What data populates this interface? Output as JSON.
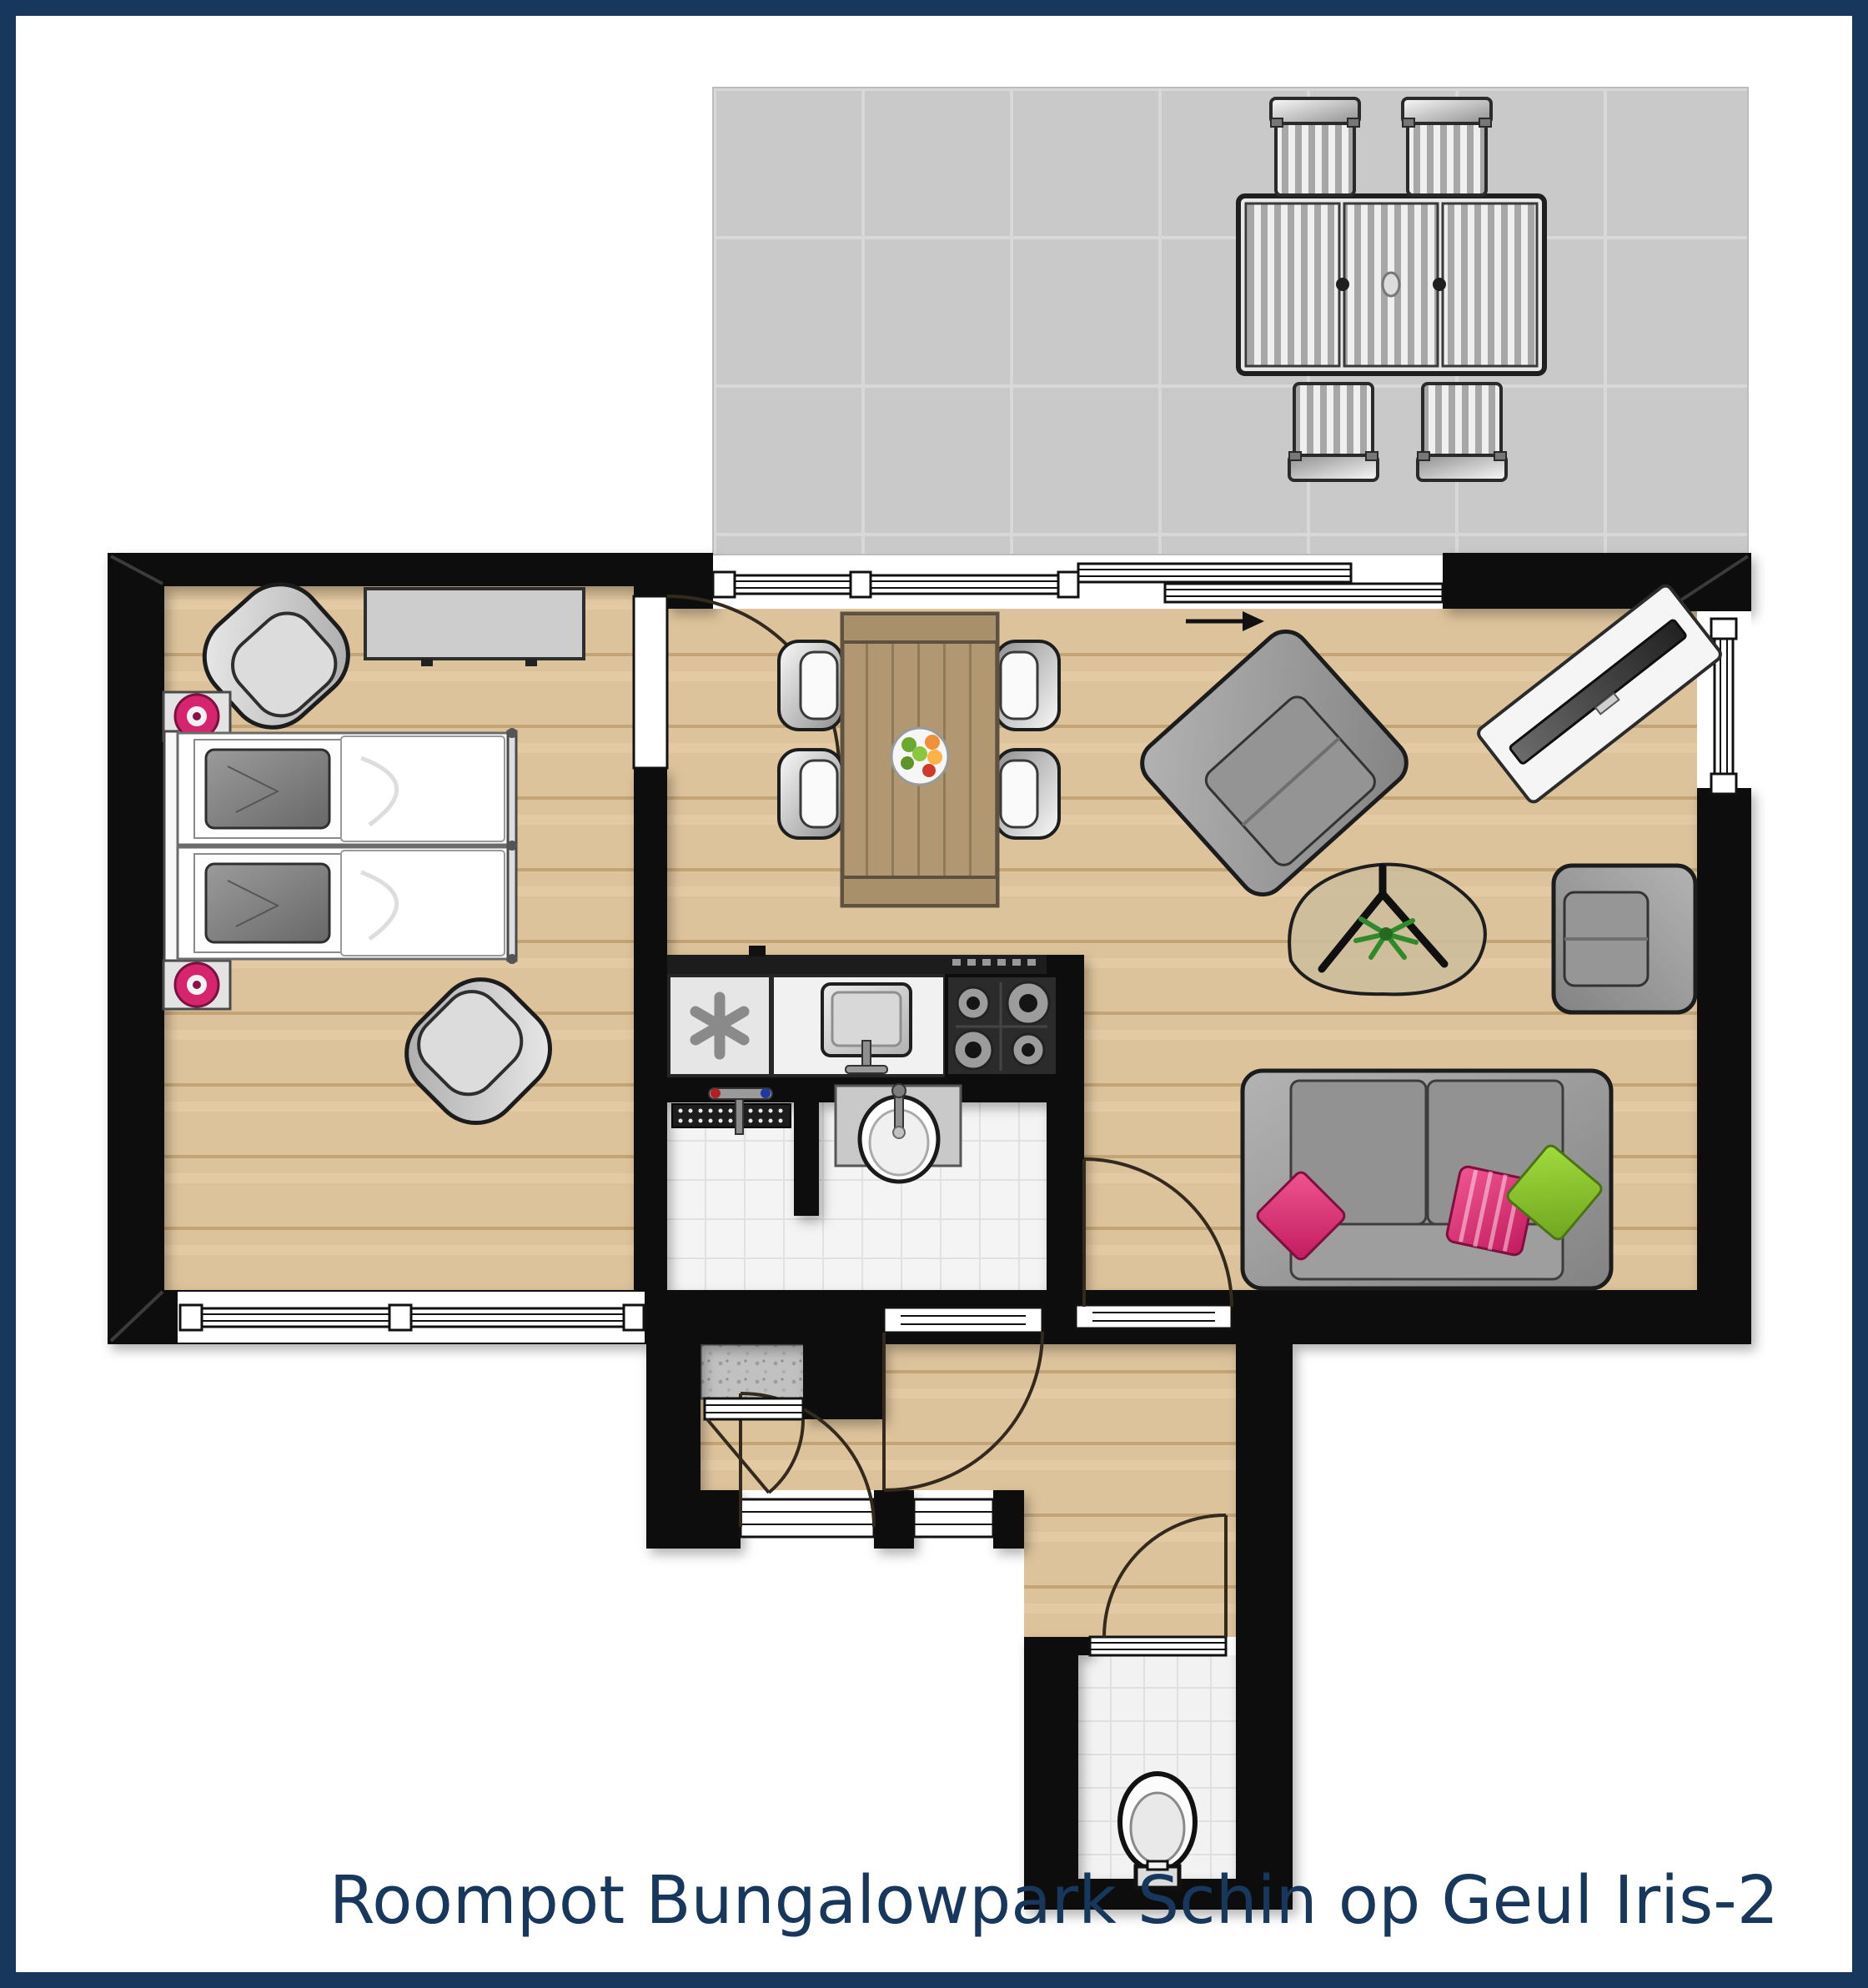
{
  "caption": {
    "text": "Roompot Bungalowpark Schin op Geul Iris-2"
  },
  "colors": {
    "frame": "#17375c",
    "caption_text": "#17375c",
    "wall": "#0c0c0c",
    "wood_floor": "#ddc39c",
    "terrace_tile": "#c9c9c9",
    "bath_tile": "#f4f4f4",
    "accent_pink": "#e0346e",
    "accent_green": "#8cc63f",
    "furniture_gray": "#9a9a9a",
    "table_wood": "#b29872"
  },
  "rooms": [
    {
      "id": "terrace",
      "furniture": [
        "patio-table",
        "patio-chair",
        "patio-chair",
        "patio-chair",
        "patio-chair"
      ]
    },
    {
      "id": "bedroom",
      "furniture": [
        "twin-beds",
        "nightstand",
        "nightstand",
        "tub-chair",
        "tub-chair",
        "dresser"
      ]
    },
    {
      "id": "living-dining",
      "furniture": [
        "dining-table",
        "fruit-bowl",
        "dining-chair",
        "dining-chair",
        "dining-chair",
        "dining-chair",
        "armchair",
        "armchair",
        "tv-sideboard",
        "coffee-table",
        "plant",
        "sofa",
        "pillow-pink",
        "pillow-pink-striped",
        "pillow-green"
      ]
    },
    {
      "id": "kitchen",
      "furniture": [
        "freezer",
        "kitchen-sink",
        "gas-hob"
      ]
    },
    {
      "id": "bathroom",
      "furniture": [
        "shower-drain",
        "shower-mixer",
        "washbasin"
      ]
    },
    {
      "id": "hall",
      "furniture": [
        "doormat-closet"
      ]
    },
    {
      "id": "toilet",
      "furniture": [
        "toilet-bowl"
      ]
    }
  ]
}
